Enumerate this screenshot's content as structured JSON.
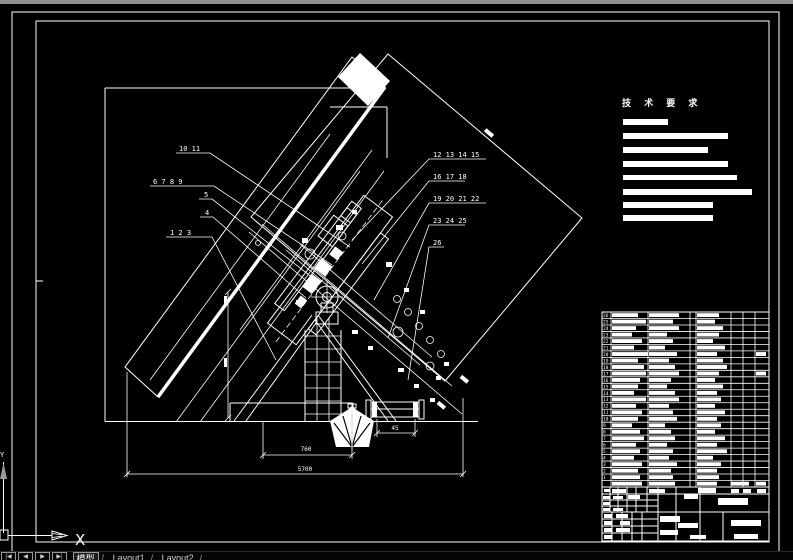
{
  "app": {
    "background": "#000000",
    "line_color": "#ffffff",
    "top_strip_color": "#8f8f8f"
  },
  "tech_requirements": {
    "title": "技 术 要 求",
    "bars": [
      [
        623,
        119,
        45,
        6
      ],
      [
        623,
        133,
        105,
        6
      ],
      [
        623,
        147,
        85,
        6
      ],
      [
        623,
        161,
        105,
        6
      ],
      [
        623,
        175,
        114,
        5
      ],
      [
        623,
        189,
        129,
        6
      ],
      [
        623,
        202,
        90,
        6
      ],
      [
        623,
        215,
        90,
        6
      ]
    ]
  },
  "callouts": {
    "left": [
      {
        "label": "10  11"
      },
      {
        "label": "6  7  8  9"
      },
      {
        "label": "5"
      },
      {
        "label": "4"
      },
      {
        "label": "1  2  3"
      }
    ],
    "right": [
      {
        "label": "12  13  14  15"
      },
      {
        "label": "16  17  18"
      },
      {
        "label": "19  20  21  22"
      },
      {
        "label": "23  24  25"
      },
      {
        "label": "26"
      }
    ]
  },
  "dimensions": {
    "overall": "5700",
    "mid": "760",
    "small": "45"
  },
  "ucs": {
    "x": "X",
    "y": "Y"
  },
  "tab_bar": {
    "nav": [
      "|◀",
      "◀",
      "▶",
      "▶|"
    ],
    "model": "模型",
    "layout1": "Layout1",
    "layout2": "Layout2",
    "sep": "/"
  },
  "bom": {
    "rows": [
      [
        26,
        26,
        30,
        22,
        0
      ],
      [
        25,
        34,
        24,
        18,
        0
      ],
      [
        24,
        24,
        30,
        26,
        0
      ],
      [
        23,
        20,
        18,
        22,
        0
      ],
      [
        22,
        30,
        24,
        16,
        0
      ],
      [
        21,
        22,
        16,
        28,
        0
      ],
      [
        20,
        36,
        28,
        20,
        1
      ],
      [
        19,
        26,
        20,
        26,
        0
      ],
      [
        18,
        32,
        26,
        30,
        0
      ],
      [
        17,
        34,
        30,
        22,
        1
      ],
      [
        16,
        28,
        22,
        18,
        0
      ],
      [
        15,
        26,
        18,
        26,
        0
      ],
      [
        14,
        22,
        26,
        20,
        0
      ],
      [
        13,
        34,
        30,
        24,
        0
      ],
      [
        12,
        24,
        20,
        18,
        0
      ],
      [
        11,
        30,
        24,
        28,
        0
      ],
      [
        10,
        26,
        28,
        20,
        0
      ],
      [
        9,
        20,
        16,
        24,
        0
      ],
      [
        8,
        28,
        22,
        18,
        0
      ],
      [
        7,
        32,
        26,
        28,
        0
      ],
      [
        6,
        24,
        18,
        20,
        0
      ],
      [
        5,
        28,
        24,
        30,
        0
      ],
      [
        4,
        22,
        20,
        16,
        0
      ],
      [
        3,
        30,
        28,
        24,
        0
      ],
      [
        2,
        26,
        22,
        20,
        0
      ],
      [
        1,
        28,
        24,
        22,
        0
      ]
    ],
    "header_bars": [
      [
        612,
        30
      ],
      [
        649,
        26
      ],
      [
        697,
        20
      ],
      [
        731,
        18
      ],
      [
        756,
        10
      ]
    ]
  },
  "title_block": {
    "bars": [
      [
        604,
        489,
        6,
        3
      ],
      [
        612,
        489,
        14,
        4
      ],
      [
        649,
        489,
        16,
        4
      ],
      [
        684,
        494,
        14,
        5
      ],
      [
        698,
        488,
        18,
        5
      ],
      [
        731,
        489,
        8,
        4
      ],
      [
        743,
        489,
        8,
        4
      ],
      [
        757,
        489,
        9,
        4
      ],
      [
        603,
        496,
        7,
        3
      ],
      [
        613,
        496,
        10,
        3
      ],
      [
        628,
        495,
        12,
        4
      ],
      [
        603,
        502,
        7,
        3
      ],
      [
        603,
        508,
        7,
        3
      ],
      [
        613,
        508,
        10,
        3
      ],
      [
        604,
        514,
        8,
        4
      ],
      [
        616,
        514,
        12,
        4
      ],
      [
        604,
        521,
        8,
        4
      ],
      [
        620,
        521,
        10,
        4
      ],
      [
        604,
        528,
        8,
        4
      ],
      [
        616,
        528,
        14,
        4
      ],
      [
        604,
        535,
        8,
        4
      ],
      [
        660,
        516,
        20,
        6
      ],
      [
        678,
        523,
        20,
        5
      ],
      [
        660,
        530,
        18,
        5
      ],
      [
        690,
        535,
        16,
        4
      ],
      [
        718,
        498,
        30,
        7
      ],
      [
        731,
        520,
        30,
        6
      ],
      [
        734,
        534,
        24,
        5
      ]
    ]
  }
}
